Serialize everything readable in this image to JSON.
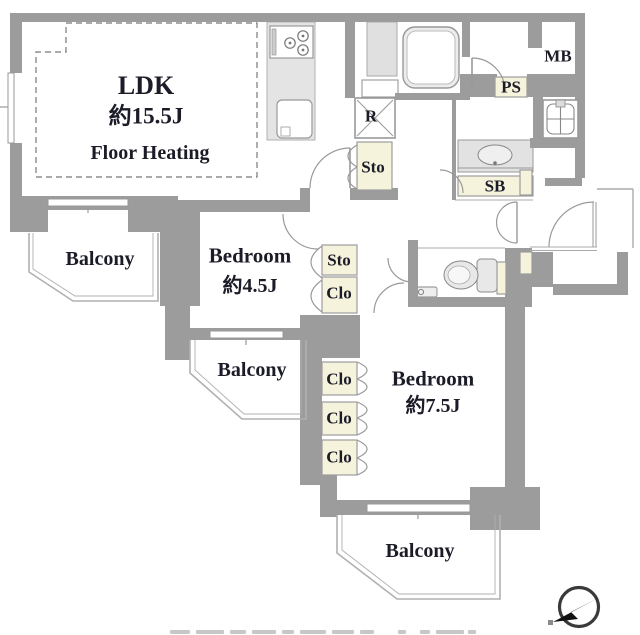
{
  "colors": {
    "wall": "#9c9c9c",
    "fixture_fill": "#e6e6e6",
    "closet_fill": "#f6f3dd",
    "thin_line": "#a0a0a0",
    "text": "#1c1c28"
  },
  "rooms": {
    "ldk": {
      "name": "LDK",
      "size": "約15.5J",
      "note": "Floor Heating"
    },
    "bedroom_small": {
      "name": "Bedroom",
      "size": "約4.5J"
    },
    "bedroom_large": {
      "name": "Bedroom",
      "size": "約7.5J"
    },
    "balcony_left": {
      "name": "Balcony"
    },
    "balcony_middle": {
      "name": "Balcony"
    },
    "balcony_bottom": {
      "name": "Balcony"
    }
  },
  "compartments": {
    "mb": "MB",
    "ps": "PS",
    "refrigerator": "R",
    "storage_hall": "Sto",
    "shoe_box": "SB",
    "storage_bedroom": "Sto",
    "closet_upper": "Clo",
    "closet_1": "Clo",
    "closet_2": "Clo",
    "closet_3": "Clo"
  },
  "icons": {
    "compass": "north-compass-arrow"
  }
}
